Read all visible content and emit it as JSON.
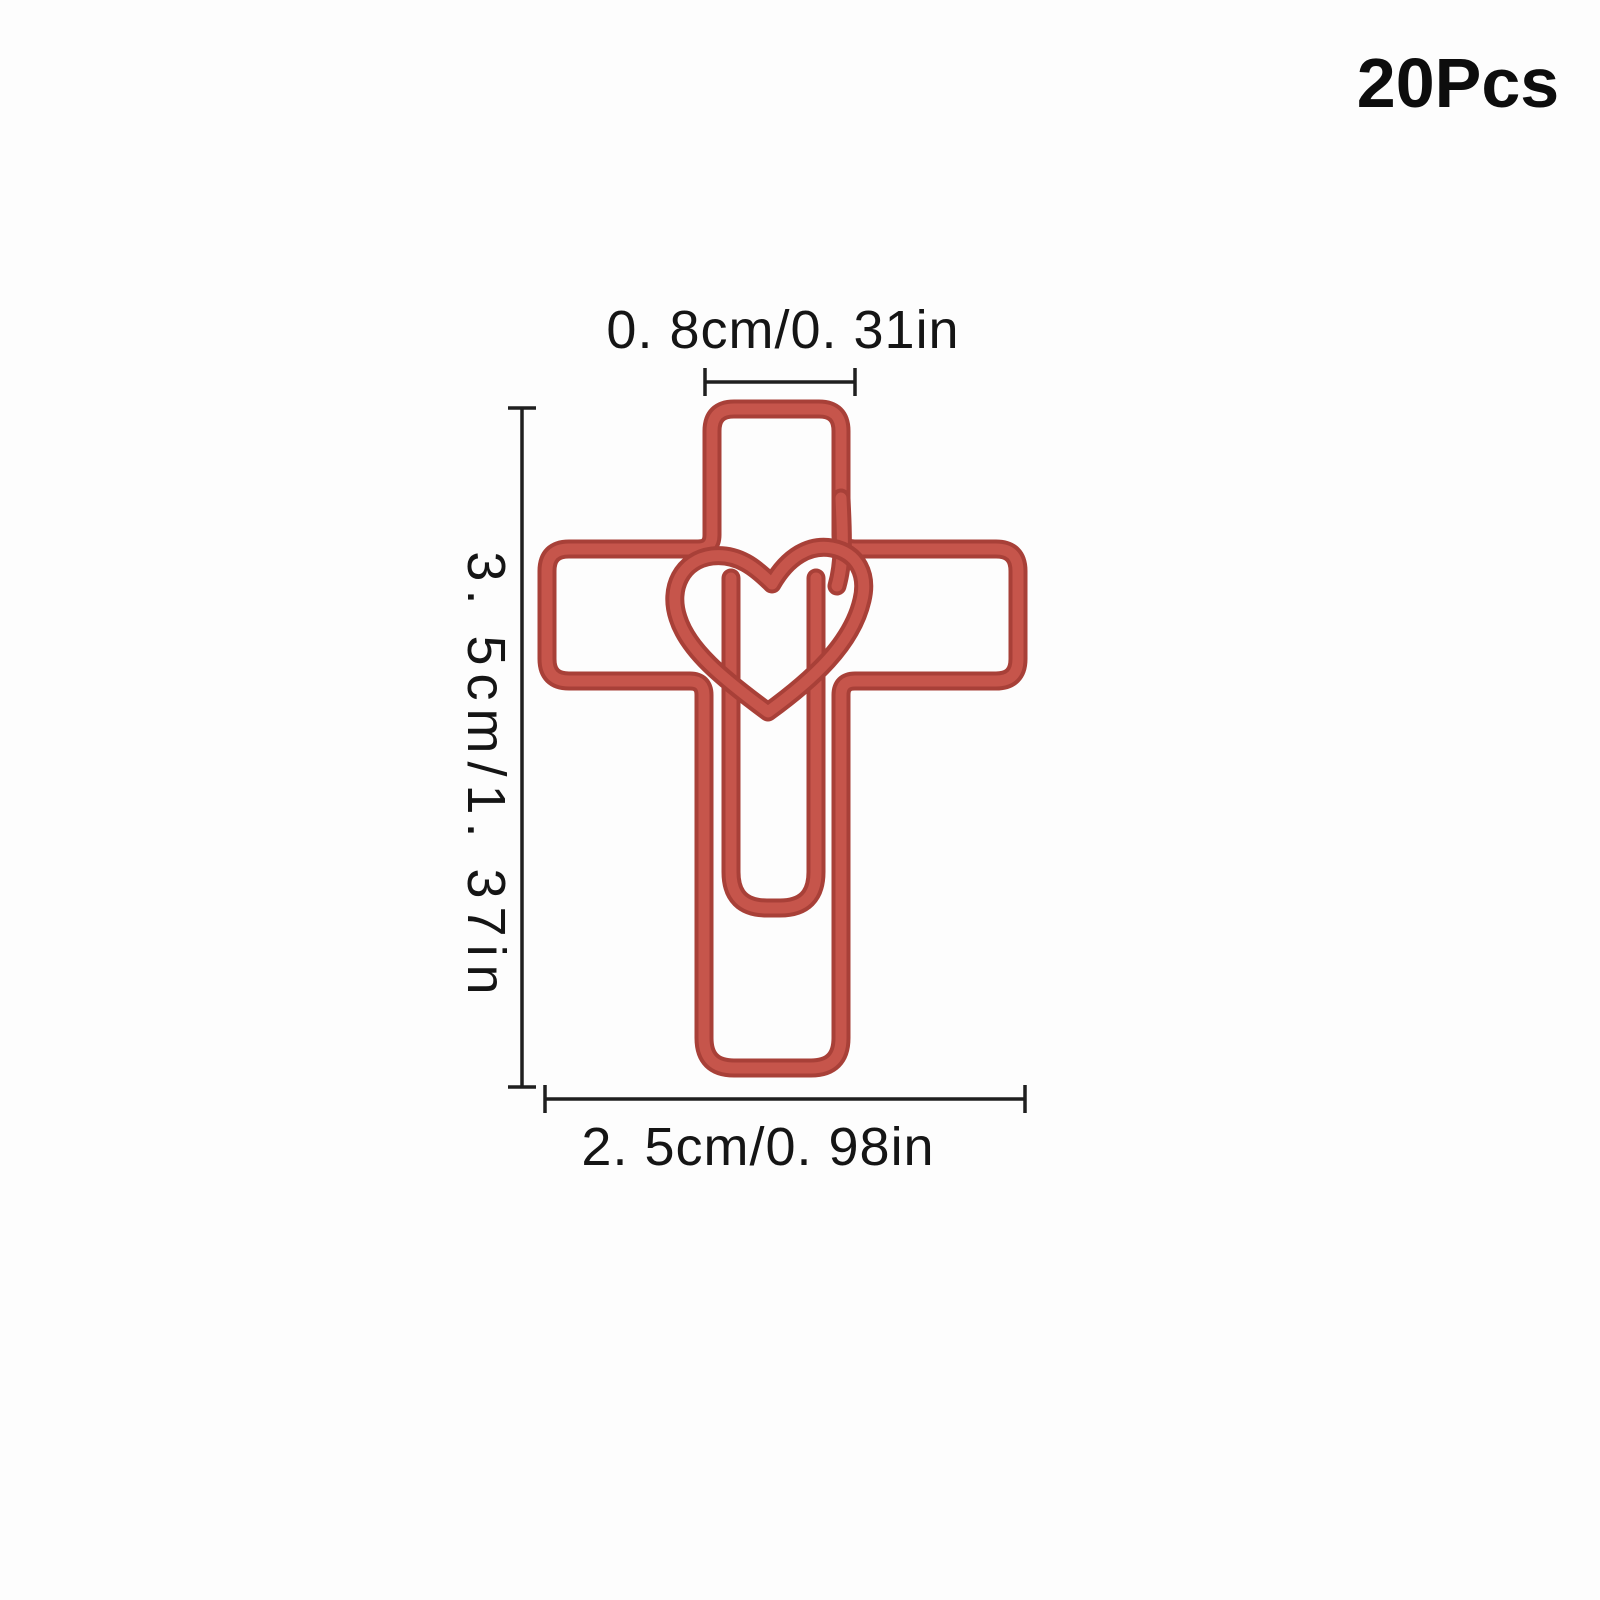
{
  "badge": {
    "quantity_label": "20Pcs"
  },
  "dimensions": {
    "top_width": {
      "label": "0. 8cm/0. 31in",
      "cm": 0.8,
      "inch": 0.31
    },
    "height": {
      "label": "3. 5cm/1. 37in",
      "cm": 3.5,
      "inch": 1.37
    },
    "bottom_width": {
      "label": "2. 5cm/0. 98in",
      "cm": 2.5,
      "inch": 0.98
    }
  },
  "colors": {
    "wire_red": "#c04b42",
    "wire_red_dark": "#a84038",
    "wire_red_light": "#c6554b",
    "annotation_black": "#1f1f1f",
    "background": "#fdfdfd"
  }
}
